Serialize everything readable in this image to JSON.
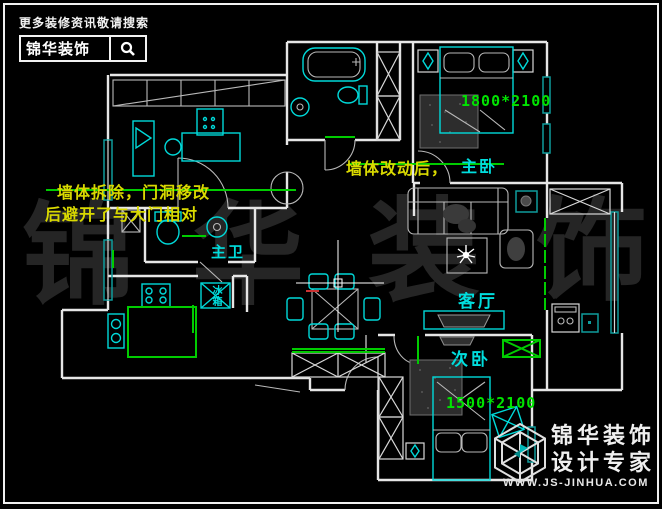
{
  "branding_top": {
    "tagline": "更多装修资讯敬请搜索",
    "logo_text": "锦华装饰",
    "search_icon": "magnifier-icon"
  },
  "notes": {
    "demolish_line1": "墙体拆除，门洞移改",
    "demolish_line2": "后避开了与大门相对",
    "wall_change": "墙体改动后，"
  },
  "room_labels": {
    "master_bedroom": "主卧",
    "living_room": "客厅",
    "second_bedroom": "次卧",
    "master_bathroom": "主卫",
    "fridge": "冰箱"
  },
  "dimension_labels": {
    "master_bed_size": "1800*2100",
    "second_bed_size": "1500*2100"
  },
  "watermark": {
    "chars": [
      "锦",
      "华",
      "装",
      "饰"
    ]
  },
  "branding_bottom": {
    "company": "锦华装饰",
    "slogan": "设计专家",
    "website": "WWW.JS-JINHUA.COM"
  },
  "colors": {
    "background": "#000000",
    "wall_white": "#e6e6e6",
    "fixture_cyan": "#00d9d9",
    "window_teal": "#0f9c9c",
    "modification_green": "#00cc00",
    "dimension_green": "#00e400",
    "annotation_yellow": "#d9d900",
    "label_cyan": "#00dede",
    "watermark_gray": "#252525"
  }
}
